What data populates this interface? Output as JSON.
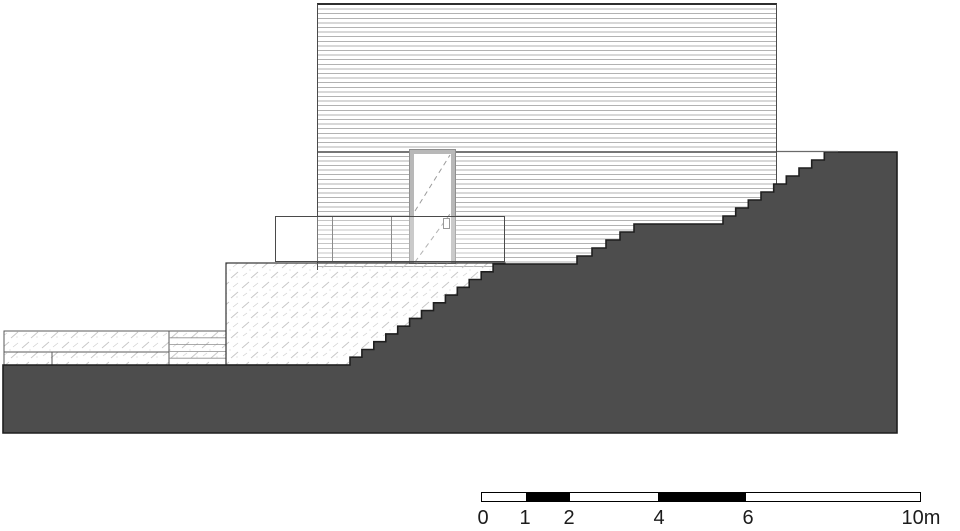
{
  "drawing": {
    "type": "architectural site section / elevation",
    "elements": {
      "facade": "horizontally-clad building volume",
      "door": "single door with dashed swing diagonals and handle",
      "railing": "low glass guardrail in front of facade",
      "retaining_block": "hatched retaining / terrace structure with stepped edge",
      "terrain": "dark stepped ground section rising left to right",
      "wall_layers_left": "layered wall build-up strips at grade on the left"
    },
    "colors": {
      "terrain_fill": "#4d4d4d",
      "terrain_outline": "#1f1f1f",
      "siding_line": "#b2b2b2",
      "building_outline": "#2e2e2e",
      "hatch_stroke": "#c6c6c6",
      "scale_black": "#000000",
      "background": "#ffffff"
    }
  },
  "scale_bar": {
    "unit": "m",
    "max_m": 10,
    "ticks_m": [
      0,
      1,
      2,
      4,
      6,
      10
    ],
    "filled_segments_m": [
      [
        1,
        2
      ],
      [
        4,
        6
      ]
    ],
    "labels": [
      "0",
      "1",
      "2",
      "4",
      "6",
      "10m"
    ]
  }
}
